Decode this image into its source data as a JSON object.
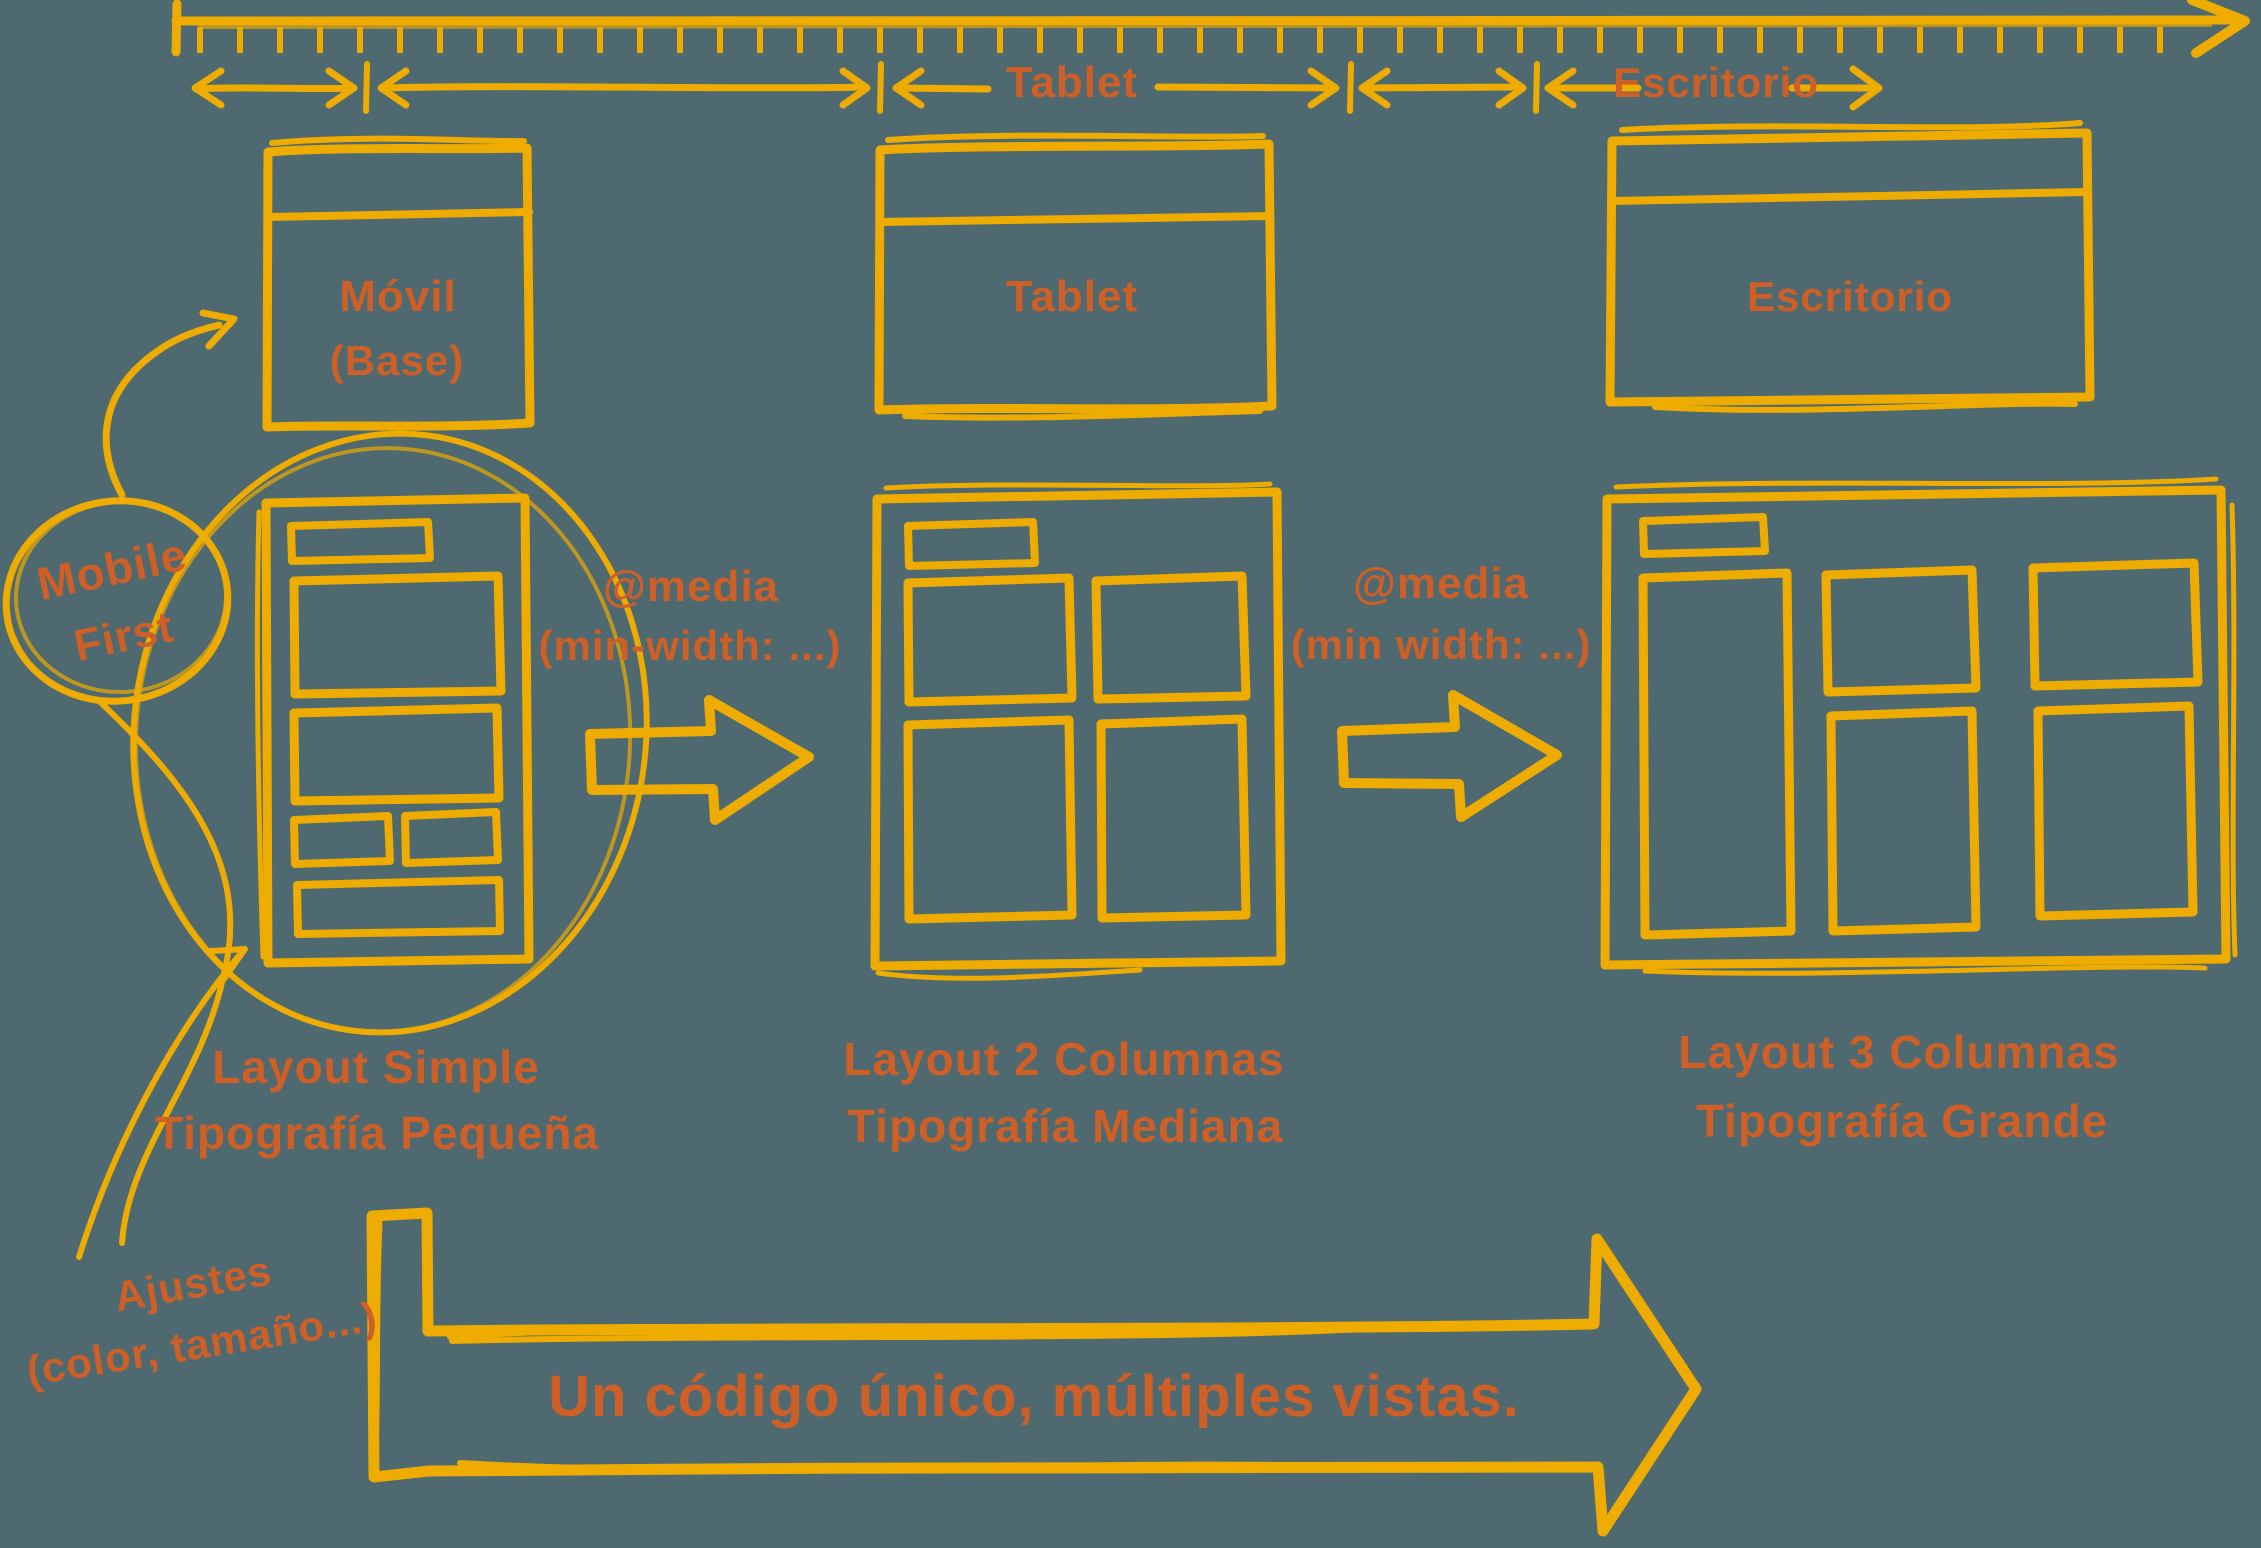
{
  "colors": {
    "background": "#4e6970",
    "sketch_yellow": "#eeab00",
    "text_orange": "#cd5f27"
  },
  "breakpoint_ranges": {
    "tablet_label": "Tablet",
    "desktop_label": "Escritorio"
  },
  "device_windows": {
    "mobile_title": "Móvil",
    "mobile_subtitle": "(Base)",
    "tablet_title": "Tablet",
    "desktop_title": "Escritorio"
  },
  "media_queries": {
    "first_line1": "@media",
    "first_line2": "(min-width: ...)",
    "second_line1": "@media",
    "second_line2": "(min width: ...)"
  },
  "stage_labels": {
    "mobile_line1": "Layout Simple",
    "mobile_line2": "Tipografía Pequeña",
    "tablet_line1": "Layout 2 Columnas",
    "tablet_line2": "Tipografía Mediana",
    "desktop_line1": "Layout 3 Columnas",
    "desktop_line2": "Tipografía Grande"
  },
  "annotations": {
    "mobile_first_line1": "Mobile",
    "mobile_first_line2": "First",
    "adjustments_line1": "Ajustes",
    "adjustments_line2": "(color, tamaño...)"
  },
  "banner": {
    "text": "Un código único, múltiples vistas."
  }
}
